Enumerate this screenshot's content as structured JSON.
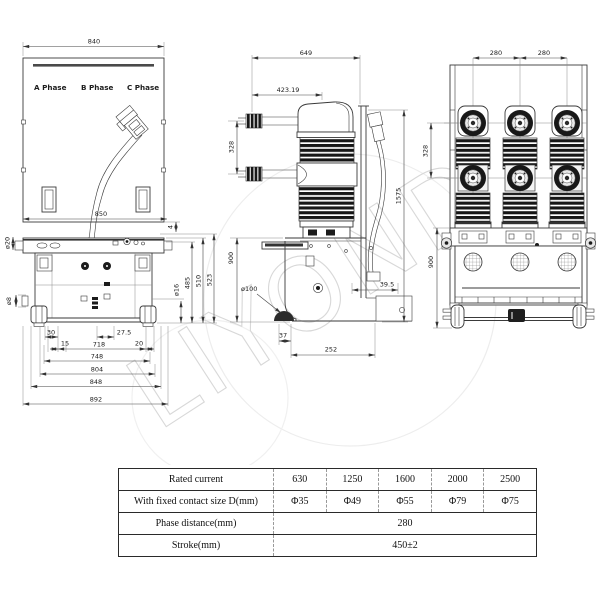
{
  "watermark": {
    "text": "LIYOND"
  },
  "front_view": {
    "phases": {
      "a": "A Phase",
      "b": "B Phase",
      "c": "C Phase"
    },
    "dims": {
      "top_width": "840",
      "frame_width": "850",
      "offset4": "4",
      "hole16": "ø16",
      "h485": "485",
      "h510": "510",
      "h523": "523",
      "hole20": "ø20",
      "hole8": "ø8",
      "d30": "30",
      "d27_5": "27.5",
      "d15": "15",
      "d718": "718",
      "d20": "20",
      "d748": "748",
      "d804": "804",
      "d848": "848",
      "d892": "892"
    }
  },
  "side_view": {
    "dims": {
      "d649": "649",
      "d423": "423.19",
      "d328": "328",
      "d1575": "1575",
      "d900": "900",
      "wheel": "ø100",
      "d37": "37",
      "d252": "252",
      "d39_5": "39.5"
    }
  },
  "rear_view": {
    "dims": {
      "d280a": "280",
      "d280b": "280",
      "d328": "328",
      "d900": "900"
    }
  },
  "spec_table": {
    "rows": [
      {
        "label": "Rated current",
        "values": [
          "630",
          "1250",
          "1600",
          "2000",
          "2500"
        ]
      },
      {
        "label": "With fixed contact size D(mm)",
        "values": [
          "Φ35",
          "Φ49",
          "Φ55",
          "Φ79",
          "Φ75"
        ]
      },
      {
        "label": "Phase distance(mm)",
        "value": "280"
      },
      {
        "label": "Stroke(mm)",
        "value": "450±2"
      }
    ]
  }
}
